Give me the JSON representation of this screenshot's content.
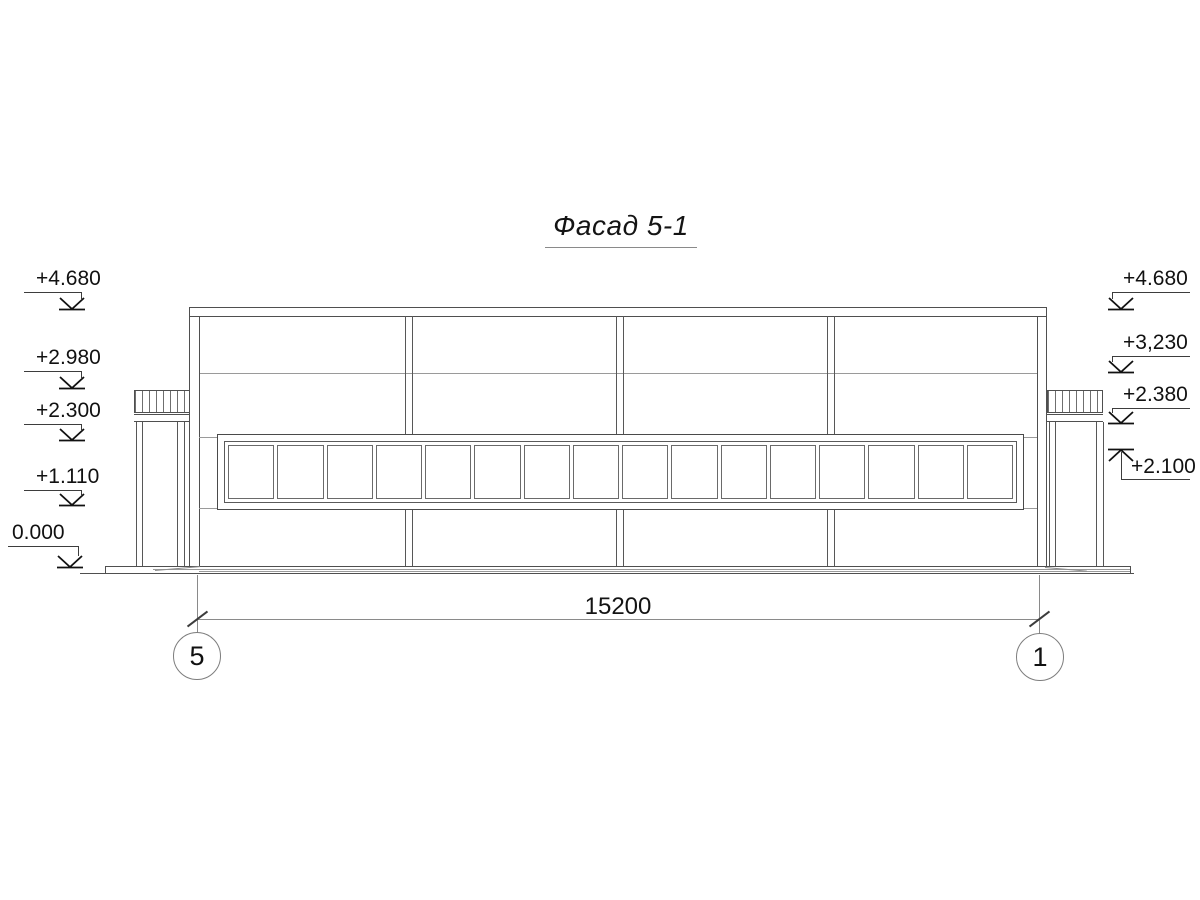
{
  "title": "Фасад 5-1",
  "marks_left": [
    {
      "label": "+4.680"
    },
    {
      "label": "+2.980"
    },
    {
      "label": "+2.300"
    },
    {
      "label": "+1.110"
    },
    {
      "label": "0.000"
    }
  ],
  "marks_right": [
    {
      "label": "+4.680"
    },
    {
      "label": "+3,230"
    },
    {
      "label": "+2.380"
    },
    {
      "label": "+2.100"
    }
  ],
  "dimension": {
    "length_label": "15200"
  },
  "axis_bubbles": [
    {
      "label": "5"
    },
    {
      "label": "1"
    }
  ],
  "window_band": {
    "pane_count": 16
  },
  "colors": {
    "ink": "#4f4f4f",
    "text": "#111111",
    "dim_lines": "#8a8a8a",
    "background": "#ffffff"
  }
}
